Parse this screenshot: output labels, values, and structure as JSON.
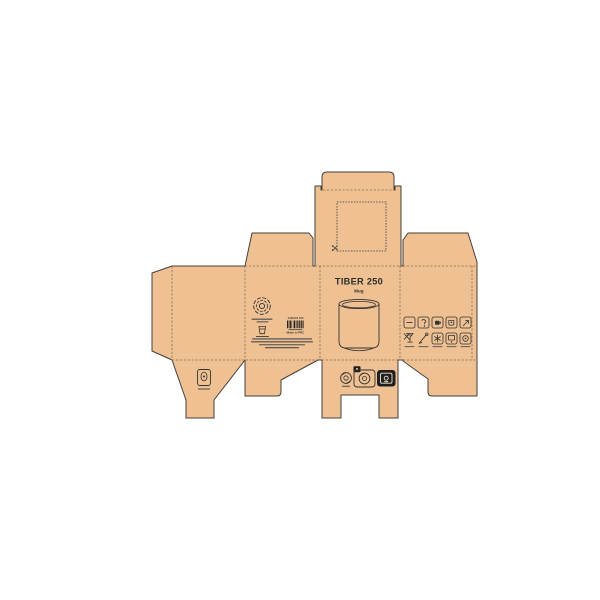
{
  "product": {
    "title": "TIBER 250",
    "subtitle": "Mug"
  },
  "back_panel": {
    "barcode_label": "AHG007 100",
    "origin_text": "Made in PRC",
    "logo": "circular-swirl-brand-logo",
    "fine_print_line_count": 4
  },
  "care_icons_row1": [
    "handle-strip-icon",
    "jug-icon",
    "hot-cup-icon",
    "cup-dot-icon",
    "arrow-up-icon"
  ],
  "care_icons_row2": [
    "no-glass-icon",
    "hand-wash-icon",
    "snowflake-box-icon",
    "screen-box-icon",
    "circle-box-icon"
  ],
  "recycling_marks": [
    "recycle-loop-mark",
    "paper-recycling-mark",
    "black-disposal-mark"
  ],
  "bottom_flap_icon": "capacity-mark",
  "lid": {
    "window": "perforated-square-window",
    "corner_mark": "scissors-mark"
  },
  "colors": {
    "background": "#ffffff",
    "kraft": "#efc192",
    "cut_line": "#44403a",
    "fold_line": "#8a6a4f",
    "ink": "#333333",
    "mark_black": "#1f1f1f"
  }
}
